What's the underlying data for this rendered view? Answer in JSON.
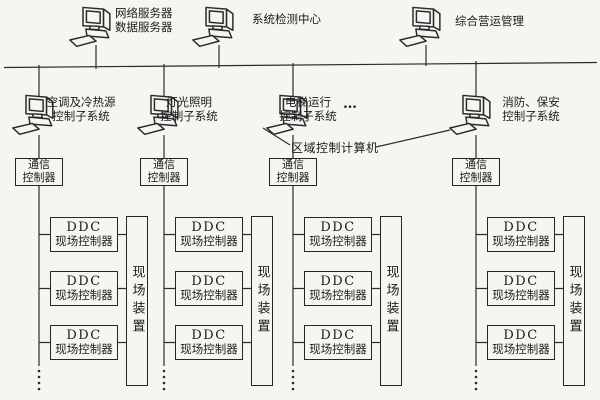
{
  "diagram": {
    "title_semantic": "楼宇自控系统网络结构图",
    "top_computers": [
      {
        "label_lines": [
          "网络服务器",
          "数据服务器"
        ]
      },
      {
        "label_lines": [
          "系统检测中心"
        ]
      },
      {
        "label_lines": [
          "综合营运管理"
        ]
      }
    ],
    "subsystem_computers": [
      {
        "label_lines": [
          "空调及冷热源",
          "控制子系统"
        ]
      },
      {
        "label_lines": [
          "灯光照明",
          "控制子系统"
        ]
      },
      {
        "label_lines": [
          "电梯运行",
          "控制子系统"
        ]
      },
      {
        "label_lines": [
          "消防、保安",
          "控制子系统"
        ]
      }
    ],
    "ellipsis": "…",
    "area_computer_caption": "区域控制计算机",
    "comm_controller": {
      "line1": "通信",
      "line2": "控制器"
    },
    "ddc_controller": {
      "line1": "DDC",
      "line2": "现场控制器"
    },
    "field_device": "现场装置",
    "colors": {
      "line": "#2b2b2b",
      "background": "#f6f5f1"
    }
  }
}
